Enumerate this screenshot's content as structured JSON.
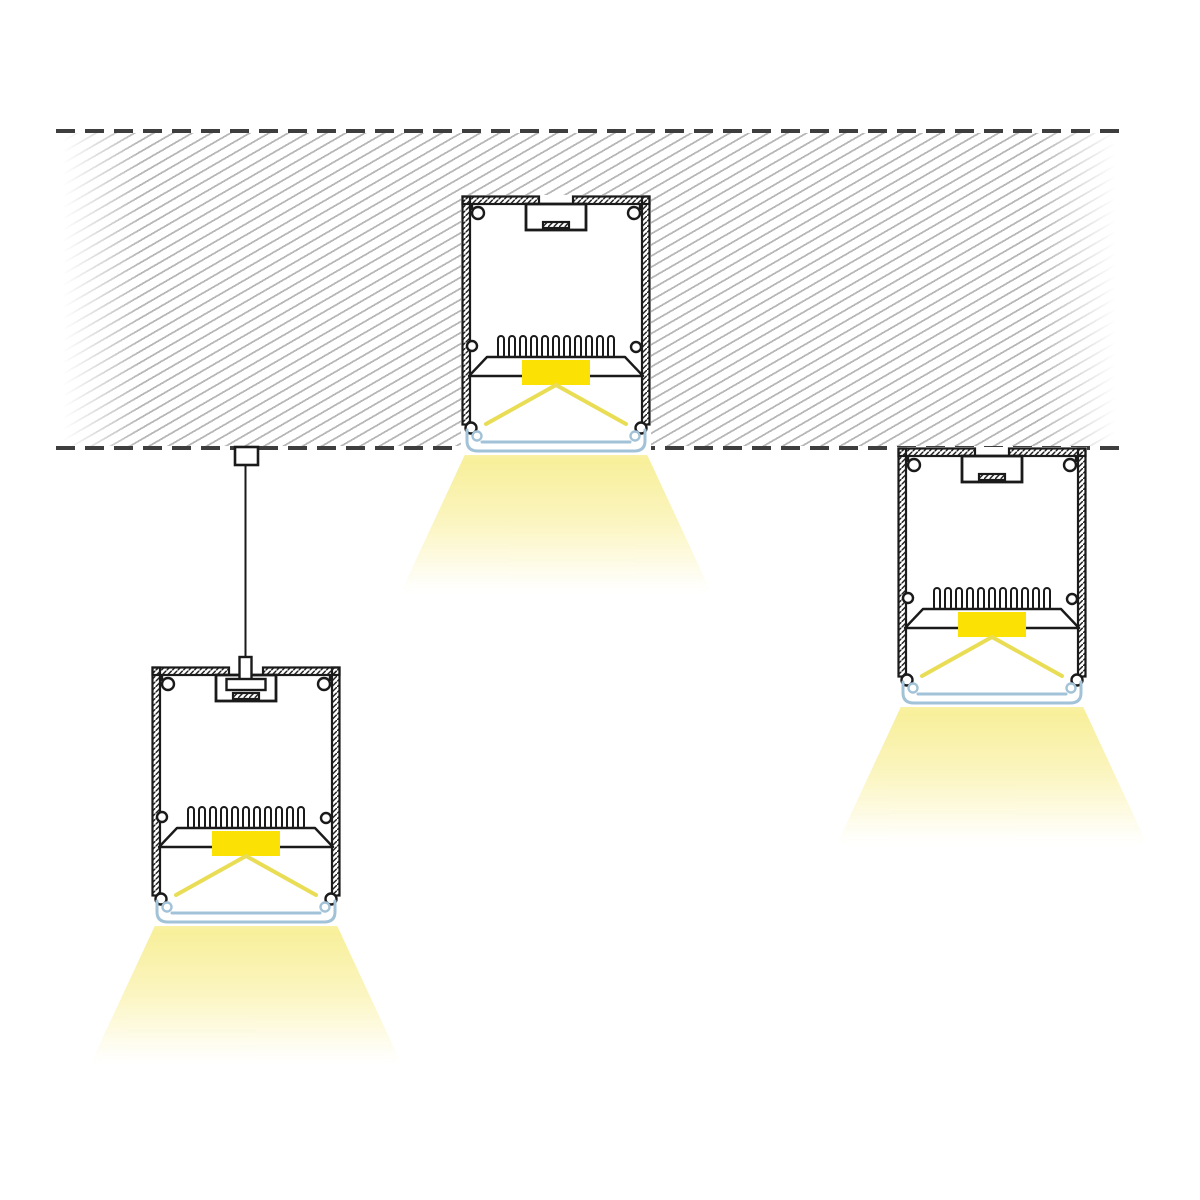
{
  "colors": {
    "canvas-bg": "#ffffff",
    "outline": "#1a1a1a",
    "dash": "#3e3e3e",
    "ceiling-hatch": "#b7b7b7",
    "led-yellow": "#fbe104",
    "ray-yellow": "#e9dd55",
    "diffuser-blue": "#a2c2d8",
    "glow-top": "#f7ee8e",
    "glow-mid": "#fbf5c0"
  },
  "scene": {
    "description_components": [
      "ceiling-slab-hatched",
      "ceiling-dashed-line-top",
      "ceiling-dashed-line-bottom",
      "recessed-led-profile",
      "suspended-led-profile",
      "surface-mounted-led-profile",
      "ceiling-mount-block",
      "suspension-cable",
      "suspension-pin",
      "t-slot-channel",
      "heatsink-fins",
      "led-strip",
      "light-rays",
      "diffuser-lens",
      "light-beam-cone"
    ],
    "luminaire_count": 3,
    "text_labels": []
  }
}
